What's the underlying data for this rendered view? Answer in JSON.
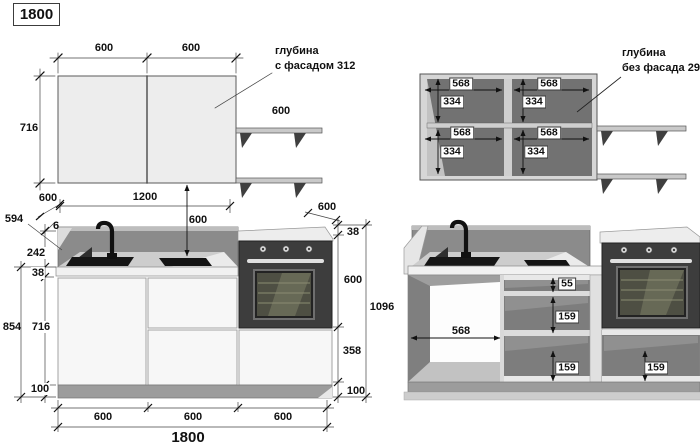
{
  "title": {
    "label": "1800"
  },
  "wall_front": {
    "dim_top_left": "600",
    "dim_top_right": "600",
    "dim_height": "716",
    "shelf_dim": "600",
    "depth_note_line1": "глубина",
    "depth_note_line2": "с фасадом 312"
  },
  "wall_open": {
    "inner_width": "568",
    "inner_height": "334",
    "depth_note_line1": "глубина",
    "depth_note_line2": "без фасада 296"
  },
  "base_front": {
    "counter_depth": "594",
    "top_edge": "6",
    "backsplash_height": "242",
    "counter_thickness": "38",
    "height_with_counter": "854",
    "front_height": "716",
    "plinth_height": "100",
    "counter_depth_left": "600",
    "wall_gap_width": "1200",
    "wall_to_counter": "600",
    "counter_depth_right": "600",
    "right_counter_thickness": "38",
    "oven_zone_height": "600",
    "lower_zone_height": "358",
    "right_plinth_height": "100",
    "total_height": "1096",
    "bottom_module_1": "600",
    "bottom_module_2": "600",
    "bottom_module_3": "600",
    "total_width": "1800"
  },
  "base_open": {
    "inner_width": "568",
    "top_drawer_depth": "55",
    "middle_drawer_depth": "159",
    "bottom_drawer_depth": "159",
    "oven_drawer_depth": "159"
  },
  "palette": {
    "carcass_light": "#ededed",
    "interior_dark": "#727272",
    "appliance_dark": "#3d3d3d",
    "backsplash": "#8b8b8b",
    "line": "#333333"
  }
}
